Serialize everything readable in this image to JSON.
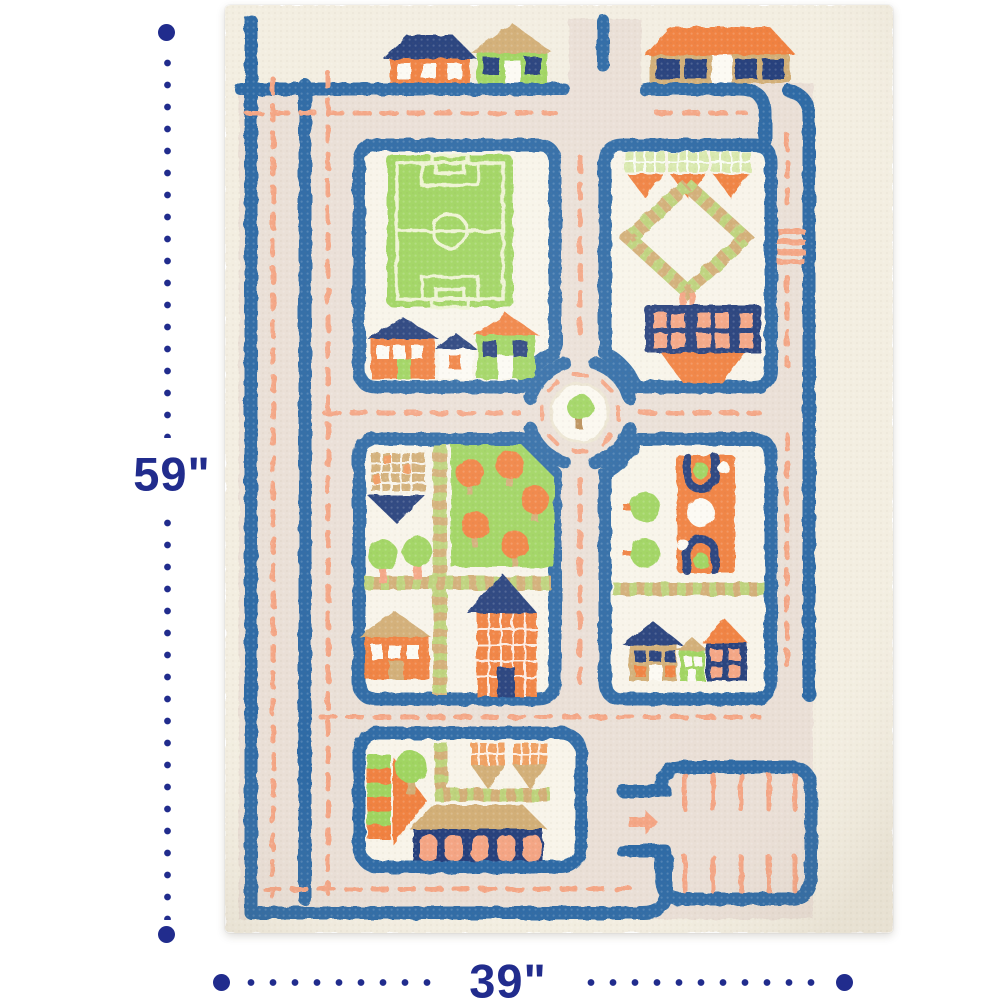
{
  "image_type": "product-dimension-photo",
  "dimensions": {
    "height_label": "59\"",
    "width_label": "39\"",
    "dot_color": "#212c8d"
  },
  "rug": {
    "description": "Kids 3D traffic play rug with roads, houses, soccer field, roundabout, market and parking lot",
    "colors": {
      "cream": "#f3eee1",
      "block": "#f8f4e9",
      "road": "#eadfd6",
      "blue": "#2d6ba5",
      "navy": "#27407c",
      "orange": "#f0813f",
      "salmon": "#f4a584",
      "green": "#9fd45e",
      "tan": "#d2ae76",
      "white": "#fcfaf3"
    },
    "features": [
      "top-houses",
      "soccer-field",
      "garden-block",
      "roundabout",
      "park-block",
      "playground-block",
      "market-block",
      "row-houses",
      "parking-lot",
      "road-network"
    ]
  }
}
